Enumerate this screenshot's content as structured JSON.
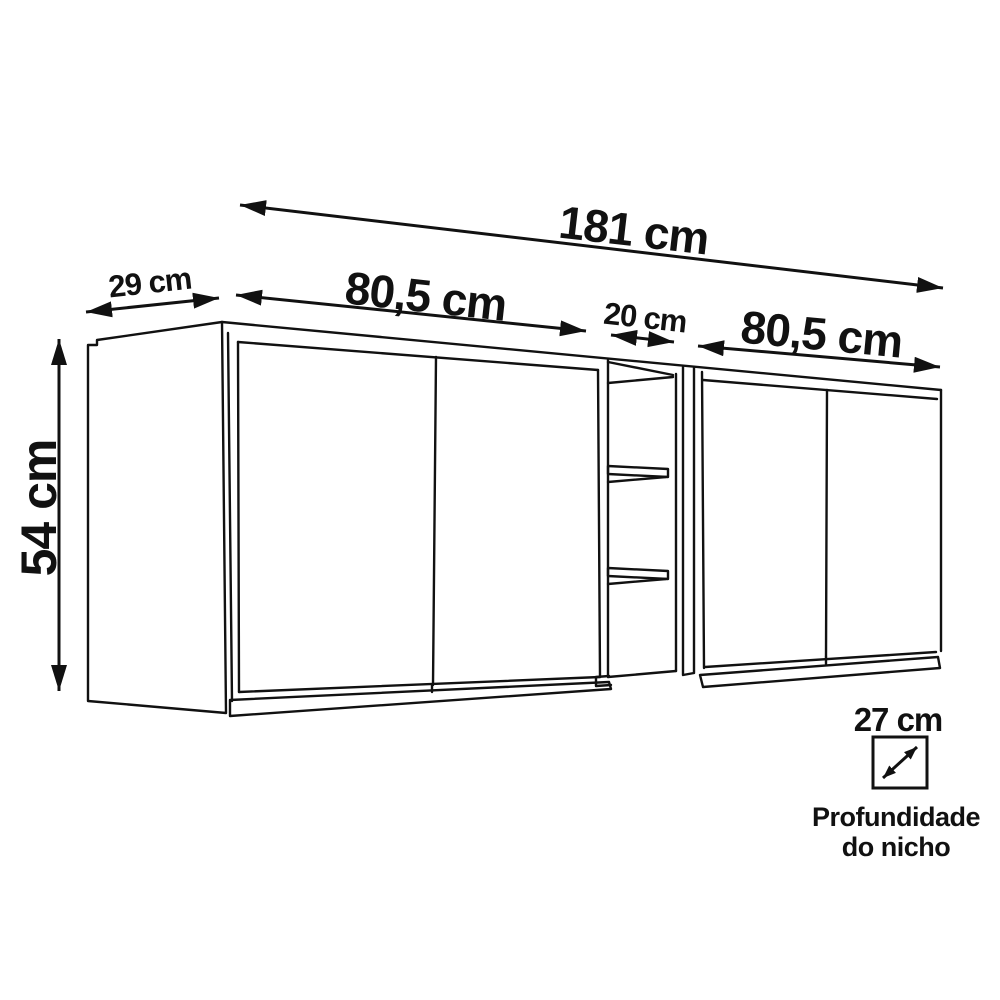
{
  "drawing": {
    "background": "#ffffff",
    "line_color": "#111111",
    "unit": "cm",
    "dimensions": {
      "total_width": "181 cm",
      "left_section_width": "80,5 cm",
      "niche_width": "20 cm",
      "right_section_width": "80,5 cm",
      "side_depth": "29 cm",
      "height": "54 cm",
      "niche_depth": "27 cm"
    },
    "captions": {
      "niche_depth_line1": "Profundidade",
      "niche_depth_line2": "do nicho"
    }
  }
}
